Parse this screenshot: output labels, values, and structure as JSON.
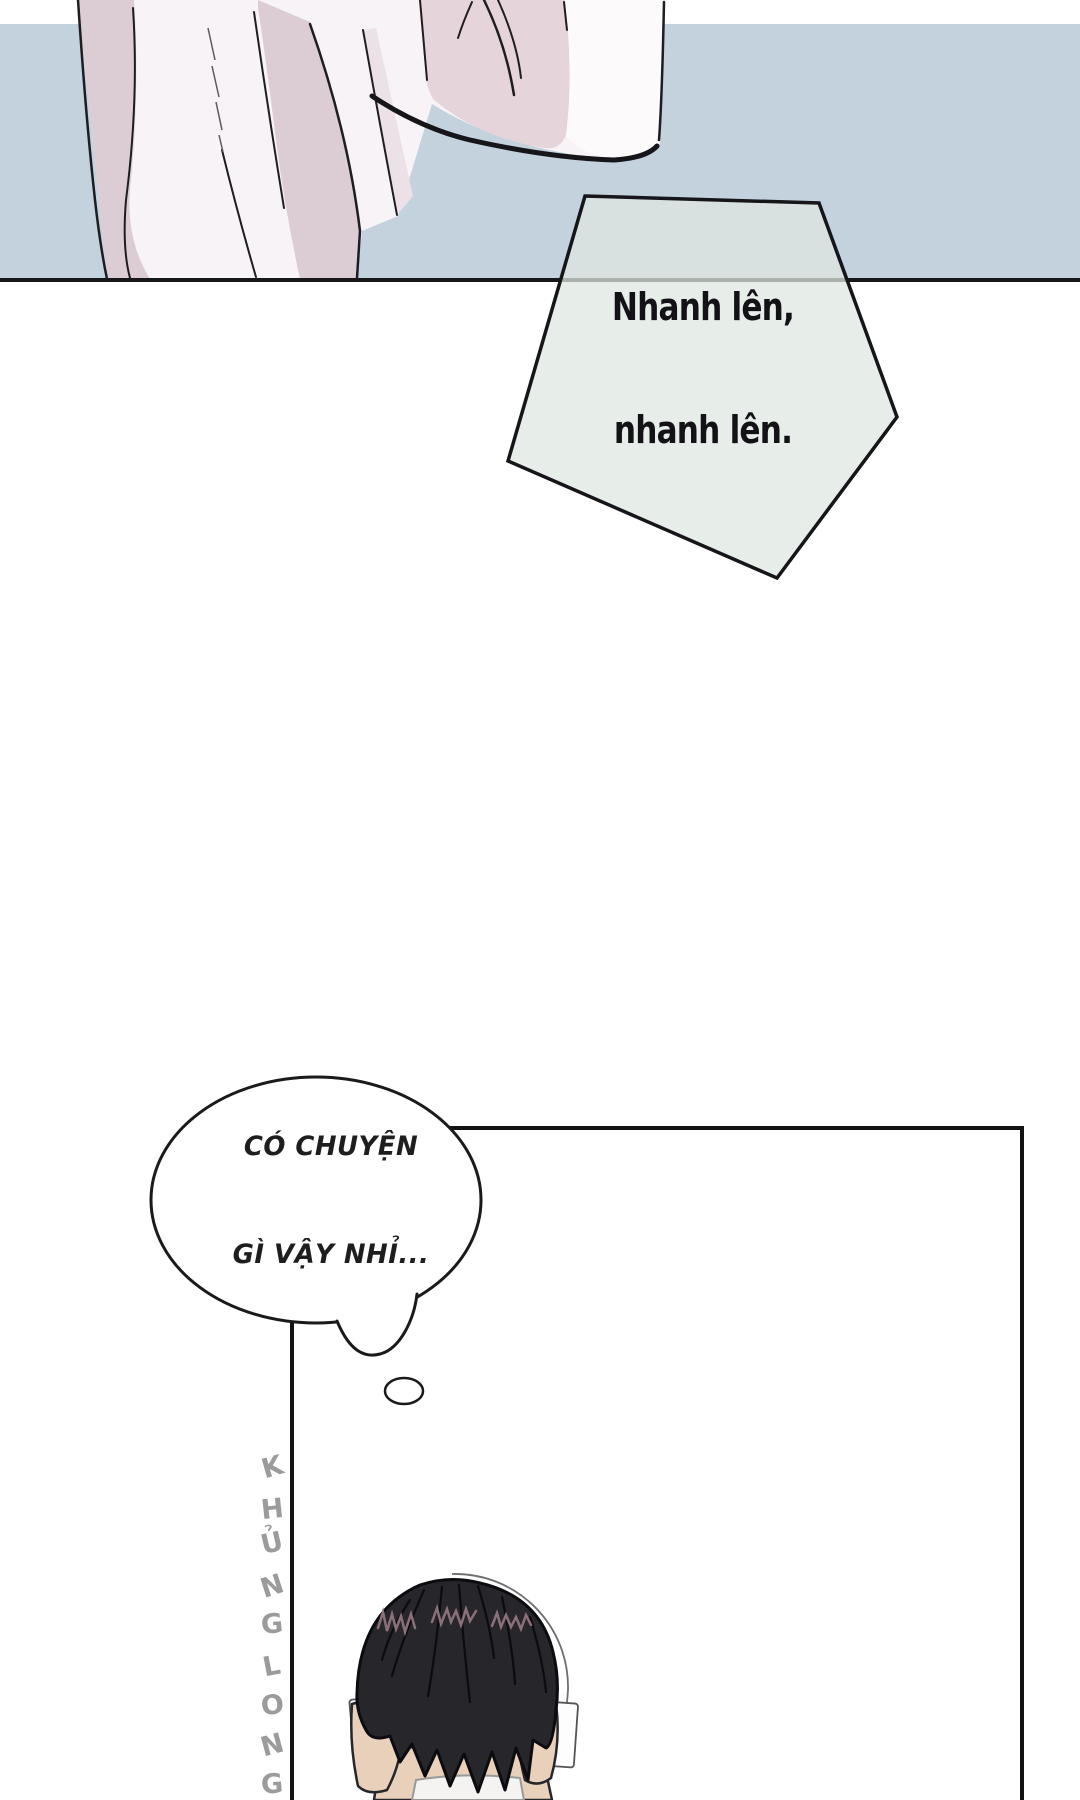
{
  "page": {
    "type": "webtoon-comic-page",
    "width": 1080,
    "height": 1800
  },
  "speech_bubble": {
    "shape": "pentagon",
    "line1": "Nhanh lên,",
    "line2": "nhanh lên."
  },
  "thought_bubble": {
    "shape": "cloud-ellipse",
    "line1": "CÓ CHUYỆN",
    "line2": "GÌ VẬY NHỈ..."
  },
  "watermark": {
    "text": "KHỦNG LONG",
    "letters": [
      "K",
      "H",
      "Ủ",
      "N",
      "G",
      "L",
      "O",
      "N",
      "G"
    ],
    "color": "#9b9b9b"
  },
  "colors": {
    "sky_blue": "#c4d2dd",
    "divider_line": "#17171a",
    "pentagon_fill": "rgb(222,231,225)",
    "robe_white": "#f7f3f6",
    "robe_pink": "#dccdd5",
    "robe_pink_pale": "#ece1e7",
    "sleeve_pink": "#e5d4da",
    "sleeve_white": "#fcfafb",
    "outline_dark": "#1a1a1a",
    "hair_black": "#26262b",
    "hair_highlight": "#8b7079",
    "skin": "#e9d0ba",
    "shirt_white": "#f4f3f2",
    "panel_border": "#131313"
  }
}
